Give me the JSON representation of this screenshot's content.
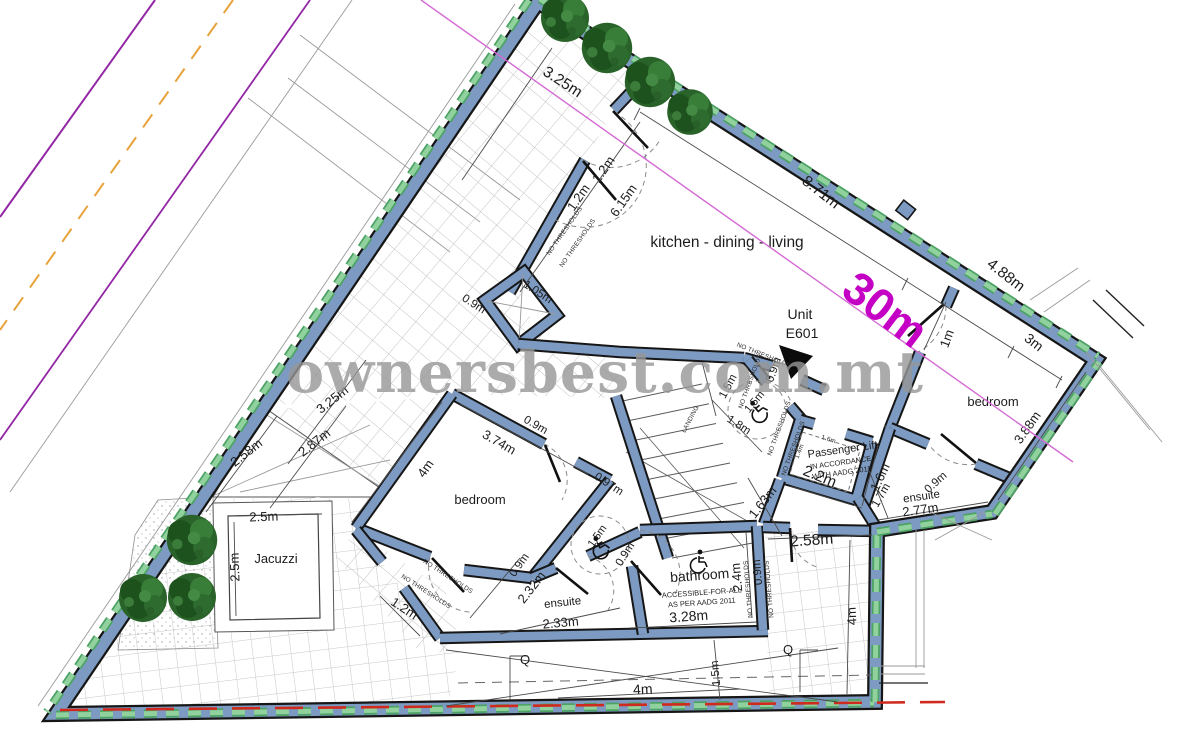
{
  "watermark": {
    "text": "ownersbest.com.mt"
  },
  "annotations": {
    "marker30": "30m",
    "unit1": "Unit",
    "unit2": "E601",
    "landing": "LANDING",
    "no_thresholds": "NO THRESHOLDS",
    "q": "Q"
  },
  "rooms": {
    "kitchen": "kitchen - dining - living",
    "bedroom_left": "bedroom",
    "bedroom_right": "bedroom",
    "ensuite_left": "ensuite",
    "ensuite_right": "ensuite",
    "bathroom": "bathroom",
    "bathroom_note_1": "ACCESSIBLE-FOR-ALL",
    "bathroom_note_2": "AS PER AADG 2011",
    "lift": "Passenger Lift",
    "lift_note_1": "IN ACCORDANCE",
    "lift_note_2": "WITH AADG 2011",
    "jacuzzi": "Jacuzzi"
  },
  "dims": {
    "m09": "0.9m",
    "m097": "0.97m",
    "m1": "1m",
    "m105": "1.05m",
    "m12": "1.2m",
    "m14": "1.4m",
    "m15": "1.5m",
    "m16": "1.6m",
    "m163": "1.63m",
    "m17": "1.7m",
    "m18": "1.8m",
    "m22": "2.2m",
    "m232": "2.32m",
    "m233": "2.33m",
    "m24": "2.4m",
    "m25": "2.5m",
    "m258": "2.58m",
    "m277": "2.77m",
    "m287": "2.87m",
    "m3": "3m",
    "m325": "3.25m",
    "m328": "3.28m",
    "m374": "3.74m",
    "m388": "3.88m",
    "m4": "4m",
    "m488": "4.88m",
    "m615": "6.15m",
    "m871": "8.71m"
  },
  "colors": {
    "wall_fill": "#7d9bc2",
    "wall_outline": "#161616",
    "boundary_dash_green": "#6cbd82",
    "marker_magenta": "#c400c4",
    "survey_line": "#d46ad4",
    "road_purple": "#9326a5",
    "road_centerline_orange": "#e8a23c",
    "red_line": "#cf2a1d"
  }
}
